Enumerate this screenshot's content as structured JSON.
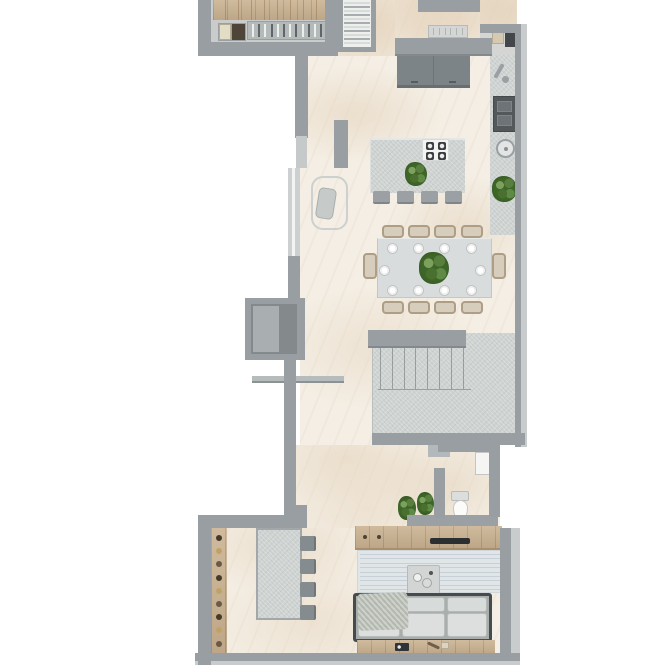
{
  "meta": {
    "label": "Apartment floor plan — top-down architectural render",
    "canvas": {
      "width": 665,
      "height": 665
    }
  },
  "palette": {
    "background": "#ffffff",
    "wall": "#989ea1",
    "wall_light": "#c8cccd",
    "floor_cream": "#f4eee4",
    "stone": "#ced3d1",
    "wood": "#c9b190",
    "dark_cabinet": "#7d8487",
    "appliance_dark": "#3e4245",
    "plant_green": "#3f6629",
    "rug": "#e0e5e8",
    "white_fixture": "#f5f5f3"
  },
  "rooms": [
    {
      "id": "walk-in-closet",
      "label": "Walk-in closet",
      "features": [
        "wood floor strip",
        "wardrobe rail with hangers",
        "drawer unit"
      ]
    },
    {
      "id": "entry",
      "label": "Entry vestibule",
      "features": [
        "entry door",
        "steep top staircase"
      ]
    },
    {
      "id": "kitchen",
      "label": "Kitchen",
      "features": [
        "dark cabinet block",
        "wall counter with faucet, oven and round sink",
        "island with cooktop",
        "bar stools",
        "plants"
      ]
    },
    {
      "id": "dining",
      "label": "Dining area",
      "features": [
        "ten-seat table",
        "place settings",
        "plant centerpiece"
      ]
    },
    {
      "id": "stairwell",
      "label": "Main stone staircase with landing"
    },
    {
      "id": "niche",
      "label": "Wall niche / shaft on left wall"
    },
    {
      "id": "wc",
      "label": "Toilet room",
      "features": [
        "washbasin cabinet",
        "toilet",
        "plants"
      ]
    },
    {
      "id": "living",
      "label": "Living room",
      "features": [
        "TV hutch",
        "wood TV console",
        "striped rug",
        "coffee table with cups",
        "three-seat sofa with throw",
        "sideboard"
      ]
    },
    {
      "id": "study",
      "label": "Study / bar strip",
      "features": [
        "wood shelf with items",
        "stone desk",
        "four chairs"
      ]
    }
  ],
  "counts": {
    "closet_hangers": 12,
    "closet_wood_planks": 8,
    "top_stair_treads": 11,
    "dish_rack_slots": 6,
    "island_stools": 4,
    "cooktop_burners": 4,
    "oven_drawers": 2,
    "dining_chairs_long_side": 4,
    "dining_plates": 10,
    "main_stair_treads": 8,
    "rug_stripes": 9,
    "sofa_seat_cushions": 3,
    "sofa_back_cushions": 3,
    "coffee_table_cups": 2,
    "console_knobs": 2,
    "shelf_items": 9,
    "study_chairs": 4,
    "wc_plants": 2,
    "plants_total": 6
  }
}
